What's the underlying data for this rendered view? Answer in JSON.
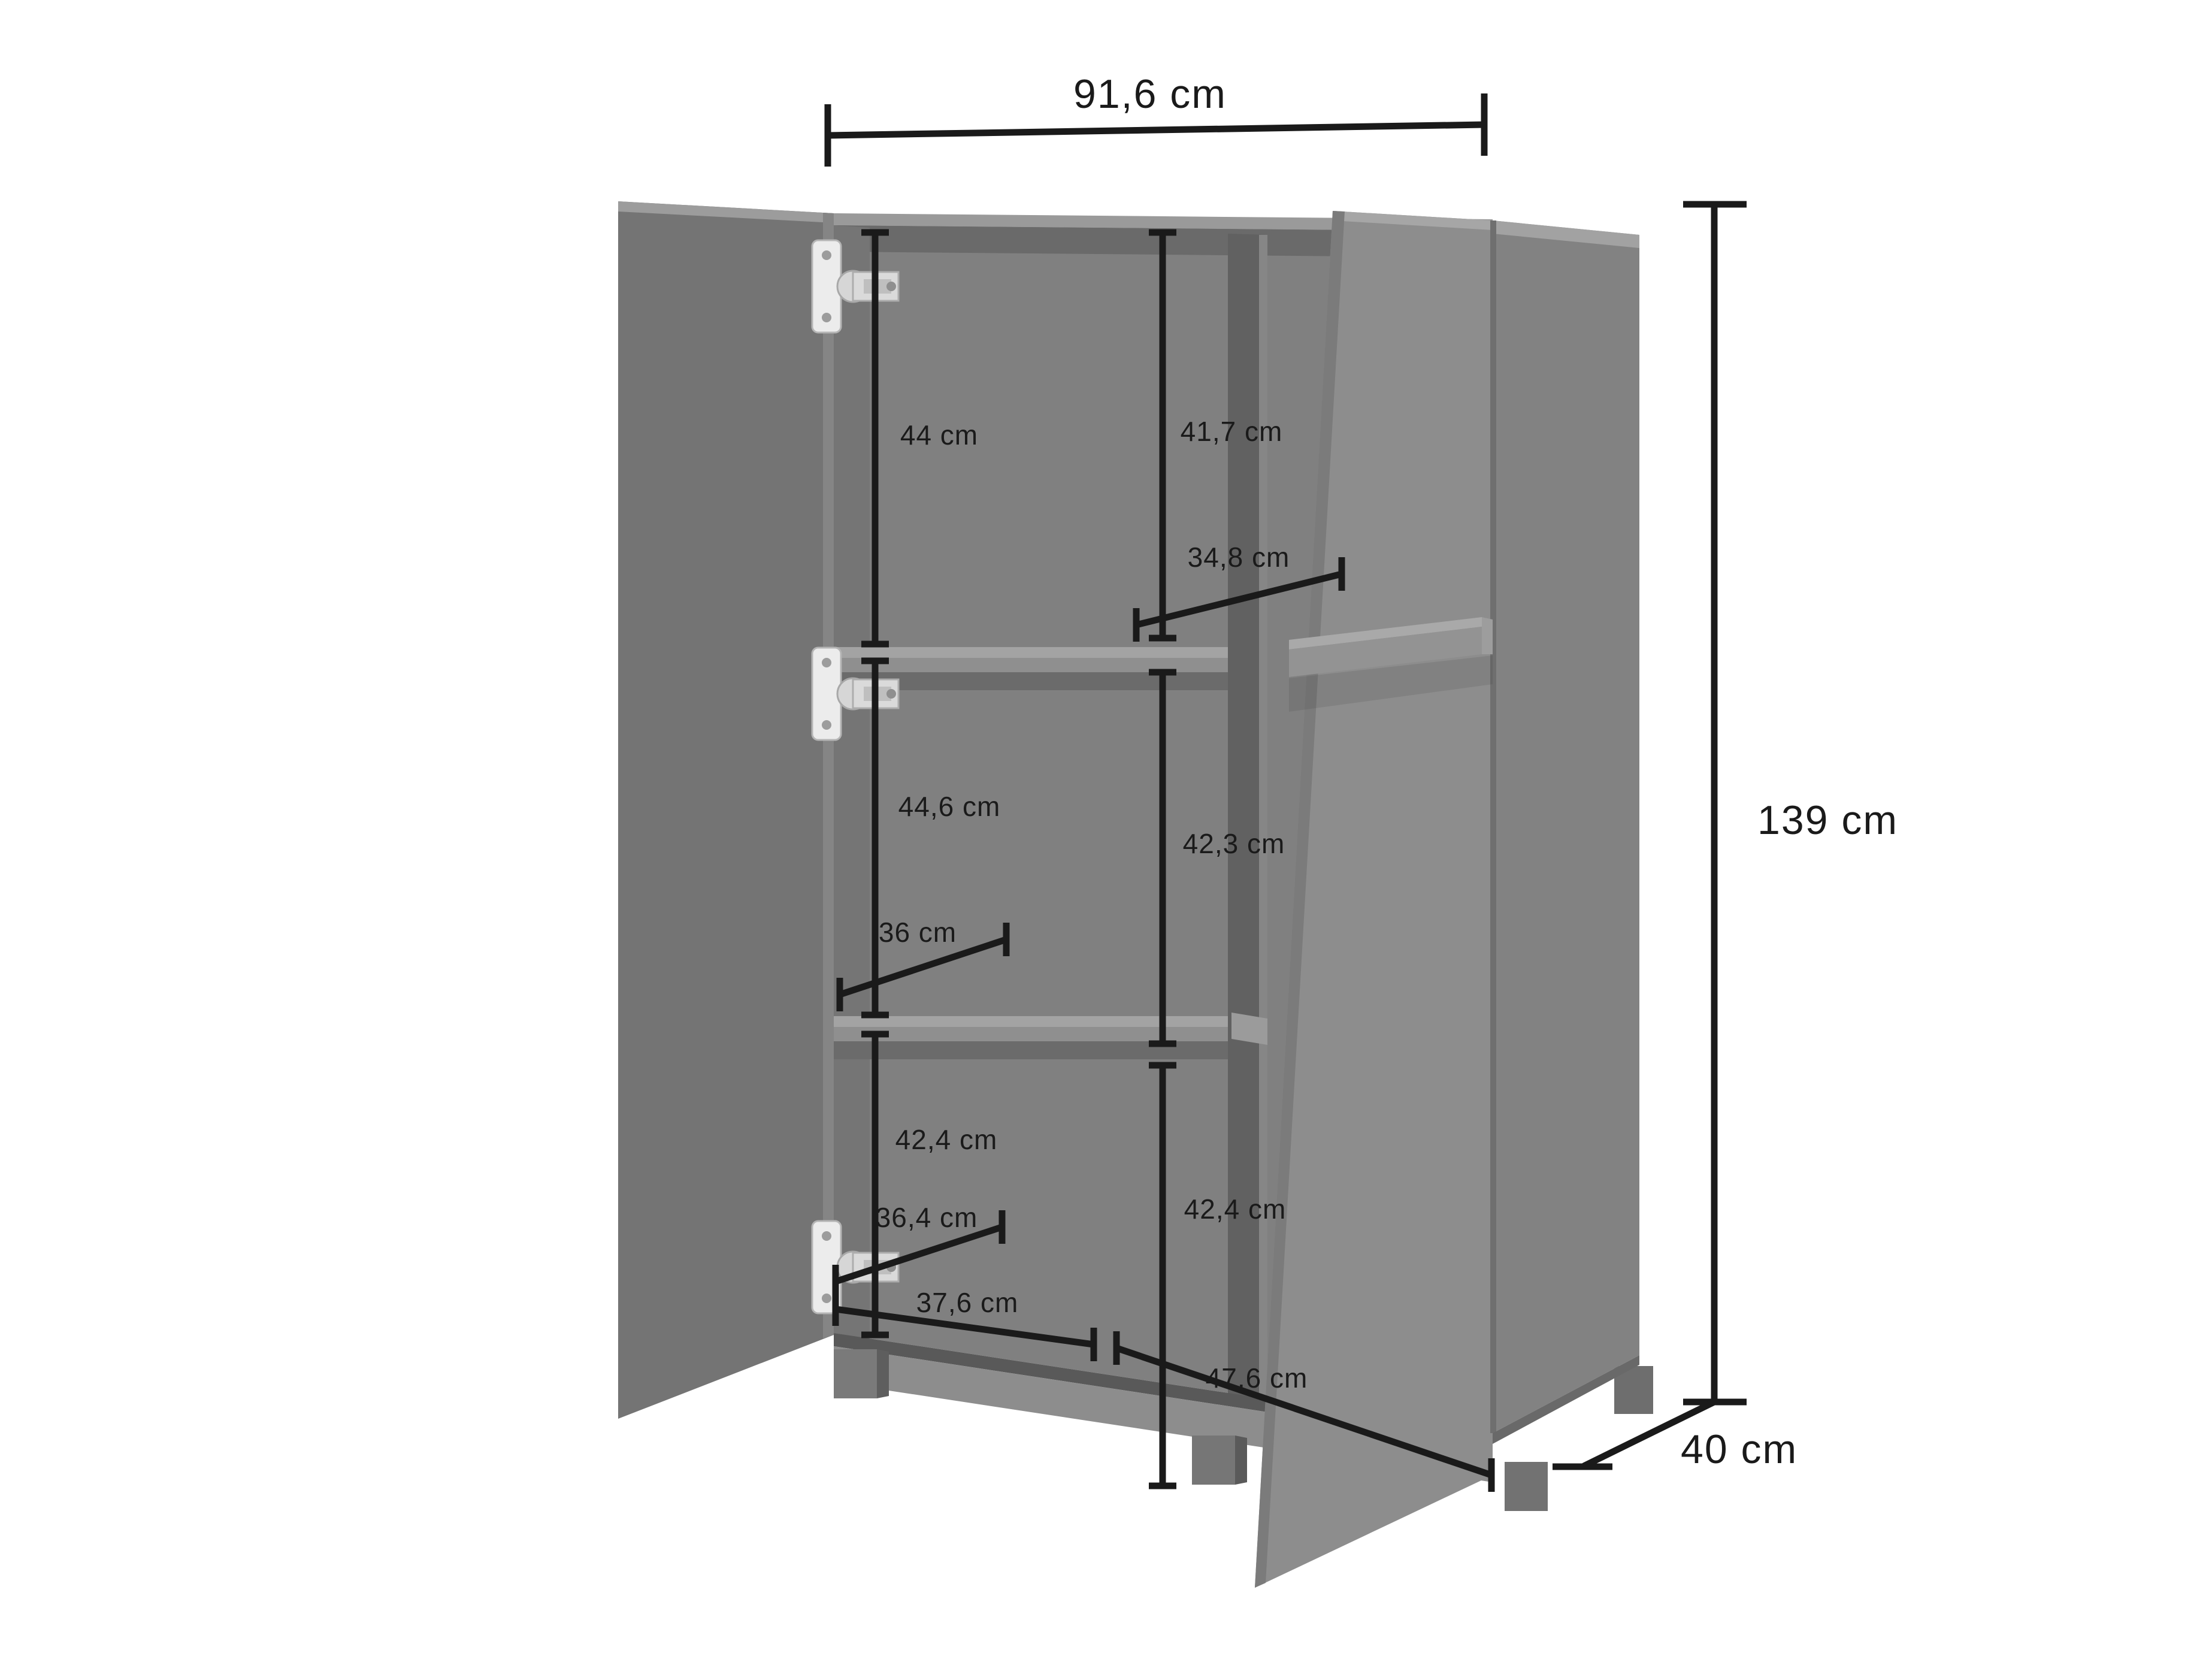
{
  "diagram": {
    "type": "furniture-dimension-diagram",
    "background_color": "#ffffff",
    "annotation_color": "#1a1a1a",
    "cabinet_color": "#7d7d7d",
    "unit": "cm",
    "overall": {
      "width_label": "91,6 cm",
      "height_label": "139 cm",
      "depth_label": "40 cm"
    },
    "interior": {
      "left_top_height": "44 cm",
      "right_top_height": "41,7 cm",
      "right_shelf_depth": "34,8 cm",
      "left_middle_height": "44,6 cm",
      "right_middle_height": "42,3 cm",
      "left_shelf_depth": "36 cm",
      "left_bottom_height": "42,4 cm",
      "left_bottom_depth": "36,4 cm",
      "right_bottom_height": "42,4 cm",
      "left_compartment_width": "37,6 cm",
      "right_compartment_width": "47,6 cm"
    }
  }
}
